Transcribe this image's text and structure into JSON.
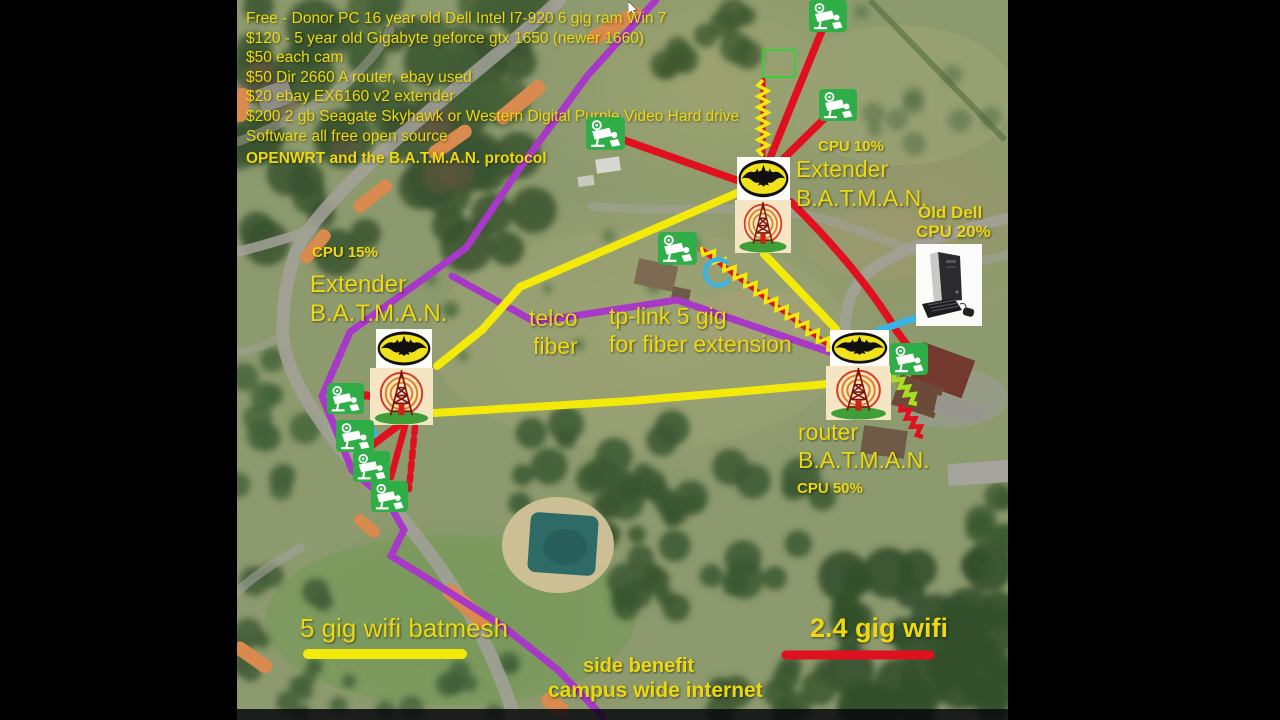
{
  "title": "campus mesh network diagram over aerial map",
  "info_list": [
    "Free - Donor PC 16 year old Dell Intel I7-920 6 gig ram Win 7",
    "$120 - 5 year old Gigabyte geforce gtx 1650 (newer 1660)",
    "$50 each cam",
    "$50 Dir 2660 A router, ebay used",
    "$20 ebay EX6160 v2 extender",
    "$200 2 gb Seagate Skyhawk or Western Digital Purple Video Hard drive",
    "Software all free open source"
  ],
  "protocol_note": "OPENWRT and the B.A.T.M.A.N. protocol",
  "nodes": {
    "central_extender": {
      "cpu": "CPU 10%",
      "name_line1": "Extender",
      "name_line2": "B.A.T.M.A.N."
    },
    "left_extender": {
      "cpu": "CPU 15%",
      "name_line1": "Extender",
      "name_line2": "B.A.T.M.A.N."
    },
    "right_router": {
      "name_line1": "router",
      "name_line2": "B.A.T.M.A.N.",
      "cpu": "CPU 50%"
    },
    "old_dell": {
      "line1": "Old Dell",
      "line2": "CPU 20%"
    }
  },
  "labels": {
    "telco_line1": "telco",
    "telco_line2": "fiber",
    "tplink_line1": "tp-link 5 gig",
    "tplink_line2": "for fiber extension",
    "wifi5_legend": "5 gig wifi batmesh",
    "wifi24_legend": "2.4 gig wifi",
    "benefit_line1": "side benefit",
    "benefit_line2": "campus wide internet"
  },
  "icons": {
    "batman": "batman-logo-icon",
    "tower": "radio-tower-icon",
    "camera": "cctv-camera-icon",
    "dell_pc": "dell-pc-photo",
    "cursor": "mouse-cursor-icon"
  },
  "colors": {
    "label_yellow": "#edd90e",
    "wifi5_line": "#f4ea0a",
    "wifi24_line": "#e0101f",
    "fiber_line": "#a838c8",
    "camera_green": "#2fae47",
    "cyan_link": "#3ab4e4",
    "lime_zigzag": "#aadd22"
  },
  "cameras": [
    {
      "x": 809,
      "y": 0,
      "w": 38,
      "h": 31
    },
    {
      "x": 819,
      "y": 89,
      "w": 38,
      "h": 33
    },
    {
      "x": 586,
      "y": 117,
      "w": 39,
      "h": 35
    },
    {
      "x": 658,
      "y": 232,
      "w": 39,
      "h": 35
    },
    {
      "x": 890,
      "y": 343,
      "w": 38,
      "h": 35
    },
    {
      "x": 327,
      "y": 383,
      "w": 37,
      "h": 30
    },
    {
      "x": 336,
      "y": 420,
      "w": 38,
      "h": 32
    },
    {
      "x": 353,
      "y": 451,
      "w": 37,
      "h": 30
    },
    {
      "x": 371,
      "y": 481,
      "w": 37,
      "h": 31
    }
  ]
}
